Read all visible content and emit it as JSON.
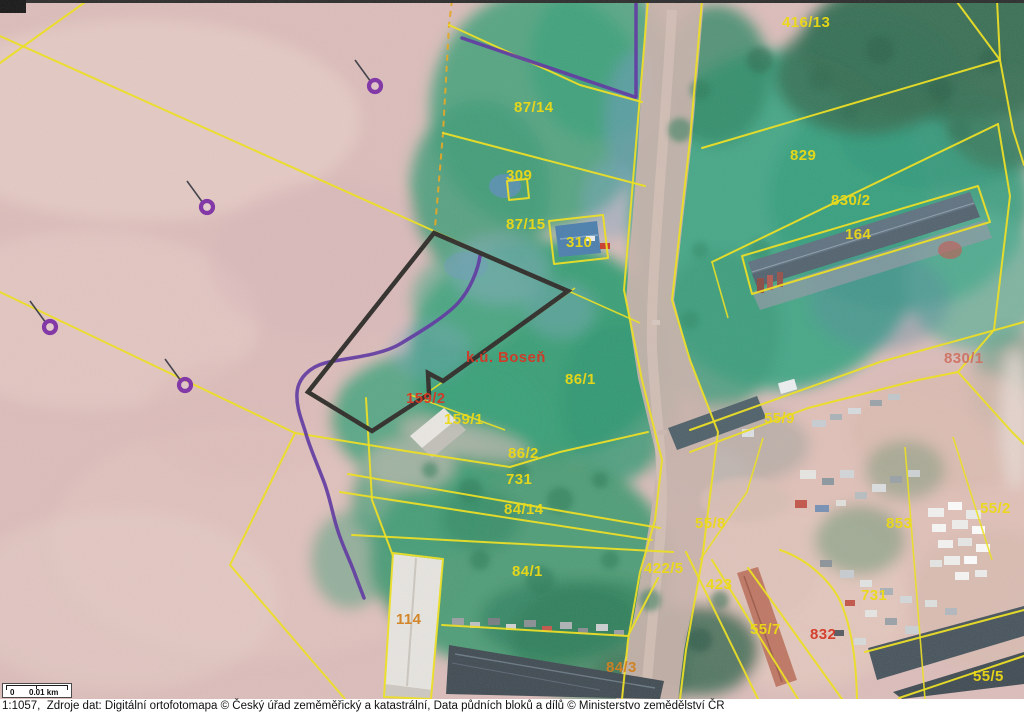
{
  "map": {
    "cadastral_area": "k.ú. Boseň",
    "labels": [
      {
        "text": "416/13",
        "x": 782,
        "y": 27,
        "color": "label_yellow"
      },
      {
        "text": "87/14",
        "x": 514,
        "y": 112,
        "color": "label_yellow"
      },
      {
        "text": "309",
        "x": 506,
        "y": 180,
        "color": "label_yellow"
      },
      {
        "text": "87/15",
        "x": 506,
        "y": 229,
        "color": "label_yellow"
      },
      {
        "text": "310",
        "x": 566,
        "y": 247,
        "color": "label_yellow"
      },
      {
        "text": "829",
        "x": 790,
        "y": 160,
        "color": "label_yellow"
      },
      {
        "text": "830/2",
        "x": 831,
        "y": 205,
        "color": "label_yellow"
      },
      {
        "text": "164",
        "x": 845,
        "y": 239,
        "color": "label_yellow"
      },
      {
        "text": "86/1",
        "x": 565,
        "y": 384,
        "color": "label_yellow"
      },
      {
        "text": "159/1",
        "x": 444,
        "y": 424,
        "color": "label_yellow"
      },
      {
        "text": "86/2",
        "x": 508,
        "y": 458,
        "color": "label_yellow"
      },
      {
        "text": "731",
        "x": 506,
        "y": 484,
        "color": "label_yellow"
      },
      {
        "text": "84/14",
        "x": 504,
        "y": 514,
        "color": "label_yellow"
      },
      {
        "text": "84/1",
        "x": 512,
        "y": 576,
        "color": "label_yellow"
      },
      {
        "text": "422/5",
        "x": 644,
        "y": 573,
        "color": "label_yellow"
      },
      {
        "text": "55/9",
        "x": 764,
        "y": 423,
        "color": "label_yellow"
      },
      {
        "text": "55/8",
        "x": 695,
        "y": 528,
        "color": "label_yellow"
      },
      {
        "text": "853",
        "x": 886,
        "y": 528,
        "color": "label_yellow"
      },
      {
        "text": "55/2",
        "x": 980,
        "y": 513,
        "color": "label_yellow"
      },
      {
        "text": "423",
        "x": 706,
        "y": 589,
        "color": "label_yellow"
      },
      {
        "text": "55/7",
        "x": 750,
        "y": 634,
        "color": "label_yellow"
      },
      {
        "text": "731",
        "x": 861,
        "y": 600,
        "color": "label_yellow"
      },
      {
        "text": "55/5",
        "x": 973,
        "y": 681,
        "color": "label_yellow"
      },
      {
        "text": "84/3",
        "x": 606,
        "y": 672,
        "color": "label_orange"
      },
      {
        "text": "114",
        "x": 396,
        "y": 624,
        "color": "label_orange"
      },
      {
        "text": "k.ú. Boseň",
        "x": 466,
        "y": 362,
        "color": "label_red",
        "size": 18,
        "name": "cadastral-area-label"
      },
      {
        "text": "159/2",
        "x": 406,
        "y": 403,
        "color": "label_red"
      },
      {
        "text": "830/1",
        "x": 944,
        "y": 363,
        "color": "label_red_faint"
      },
      {
        "text": "832",
        "x": 810,
        "y": 639,
        "color": "label_red"
      }
    ],
    "survey_markers": [
      {
        "x": 375,
        "y": 86
      },
      {
        "x": 207,
        "y": 207
      },
      {
        "x": 50,
        "y": 327
      },
      {
        "x": 185,
        "y": 385
      }
    ]
  },
  "scale_bar": {
    "zero_label": "0",
    "distance_label": "0.01 km"
  },
  "footer": {
    "attribution": "1:1057,  Zdroje dat: Digitální ortofotomapa © Český úřad zeměměřický a katastrální, Data půdních bloků a dílů © Ministerstvo zemědělství ČR"
  },
  "colors": {
    "label_yellow": "#ecd916",
    "label_red": "#d43826",
    "label_orange": "#d2801f",
    "label_red_faint": "#cd7263",
    "parcel_line_yellow": "#f0e31c",
    "lpis_purple": "#5c34a2",
    "highlight_black": "#2d2b27"
  }
}
